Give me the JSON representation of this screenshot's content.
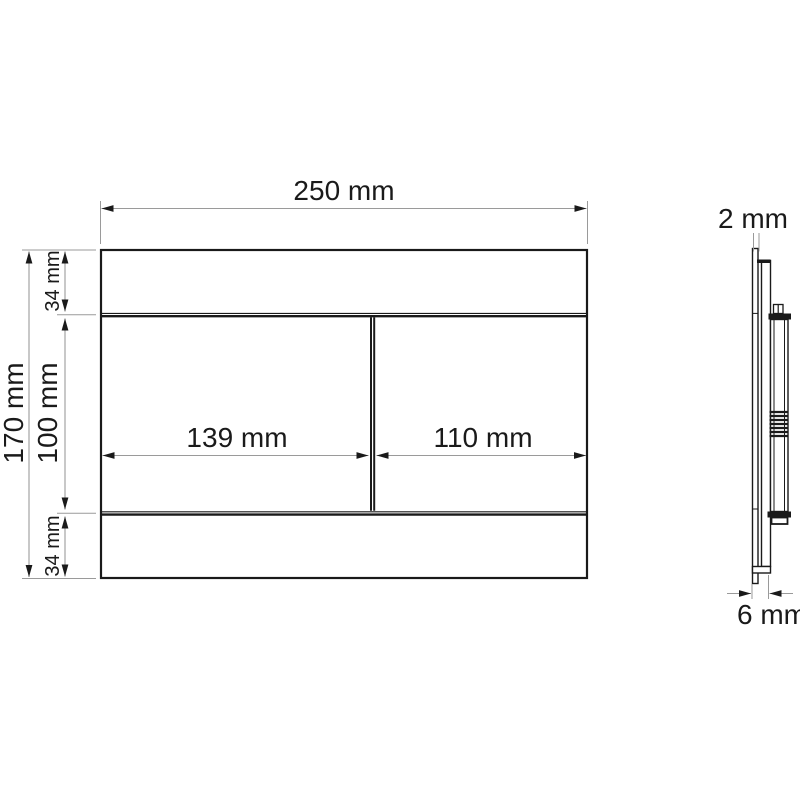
{
  "front_view": {
    "width": "250 mm",
    "height": "170 mm",
    "top_strip": "34 mm",
    "center_height": "100 mm",
    "bottom_strip": "34 mm",
    "left_button_width": "139 mm",
    "right_button_width": "110 mm"
  },
  "side_view": {
    "plate_thickness": "2 mm",
    "total_depth": "6 mm"
  },
  "colors": {
    "outline": "#1a1a1a",
    "dimension": "#9a9a9a",
    "background": "#ffffff"
  }
}
